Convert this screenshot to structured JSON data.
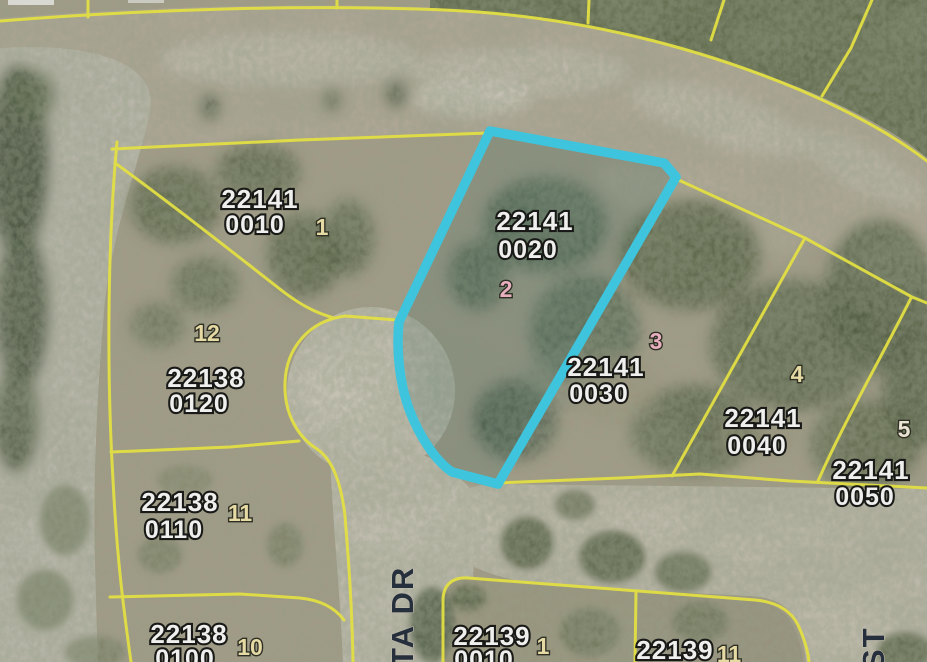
{
  "map": {
    "type": "aerial-parcel-plat-map",
    "colors": {
      "highlight_outline": "#3bc8df",
      "parcel_boundary": "#e8e43e",
      "parcel_text": "#f6f5f1",
      "lot_tan": "#eddfa4",
      "lot_pink": "#f0b2c0",
      "lot_white": "#efe8d4",
      "street_text": "#222b36"
    },
    "highlighted_parcel": {
      "strap1": "22141",
      "strap2": "0020",
      "lot": "2"
    },
    "parcels": [
      {
        "strap1": "22141",
        "strap2": "0010",
        "lot": "1",
        "lot_color": "#eddfa4"
      },
      {
        "strap1": "22141",
        "strap2": "0020",
        "lot": "2",
        "lot_color": "#f0b2c0"
      },
      {
        "strap1": "22141",
        "strap2": "0030",
        "lot": "3",
        "lot_color": "#f0b2c0"
      },
      {
        "strap1": "22141",
        "strap2": "0040",
        "lot": "4",
        "lot_color": "#eddfa4"
      },
      {
        "strap1": "22141",
        "strap2": "0050",
        "lot": "5",
        "lot_color": "#efe8d4"
      },
      {
        "strap1": "22138",
        "strap2": "0120",
        "lot": "12",
        "lot_color": "#eddfa4"
      },
      {
        "strap1": "22138",
        "strap2": "0110",
        "lot": "11",
        "lot_color": "#eddfa4"
      },
      {
        "strap1": "22138",
        "strap2": "0100",
        "lot": "10",
        "lot_color": "#eddfa4"
      },
      {
        "strap1": "22139",
        "strap2": "0010",
        "lot": "1",
        "lot_color": "#eddfa4"
      },
      {
        "strap1": "22139",
        "strap2": "",
        "lot": "11",
        "lot_color": "#eddfa4"
      }
    ],
    "streets": [
      {
        "name": "TA DR"
      },
      {
        "name": "ST"
      }
    ]
  }
}
